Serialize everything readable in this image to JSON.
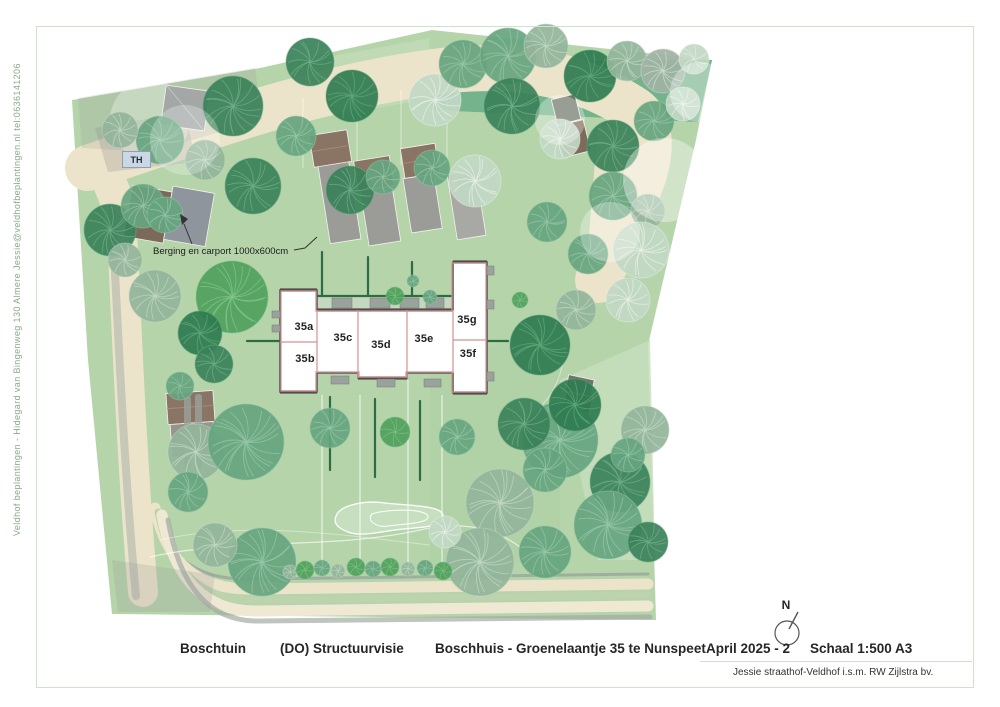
{
  "sidebar": {
    "text": "Veldhof beplantingen - Hidegard van Bingenweg 130 Almere   Jessie@veldhofbeplantingen.nl   tel:0636141206"
  },
  "plan": {
    "th_label": "TH",
    "annotation_carport": "Berging en carport 1000x600cm",
    "north_label": "N",
    "units": [
      {
        "label": "35a"
      },
      {
        "label": "35b"
      },
      {
        "label": "35c"
      },
      {
        "label": "35d"
      },
      {
        "label": "35e"
      },
      {
        "label": "35f"
      },
      {
        "label": "35g"
      }
    ],
    "colors": {
      "lawn": "#b5d4aa",
      "lawn_light": "#c7dfbe",
      "band_dark": "#74b38c",
      "path_cream": "#ece4ca",
      "path_cream2": "#efe8d2",
      "road_gray": "#a2aba3",
      "road_sage": "#bcd3ae",
      "roof_brown": "#8a7463",
      "building_gray": "#9b9b97",
      "building_gray_light": "#a8a8a4",
      "berging_brown": "#7b6a5a",
      "carport_gray": "#8e959c",
      "dark_roof": "#6e7568",
      "building_fill": "#ffffff",
      "wall_dark": "#4f4f4f",
      "partition_red": "#d49090",
      "hedge_green": "#2f6b45",
      "terrace": "#cdd8c8",
      "pond": "#c6e0bf",
      "frame": "#cfe0cb",
      "text_dark": "#262626",
      "side_text_green": "#85ab85",
      "th_bg": "#ccd7e6",
      "tree_palettes": {
        "d": [
          "#3a8159",
          "#70ae89"
        ],
        "m": [
          "#66a47f",
          "#98c7aa"
        ],
        "s": [
          "#93b49a",
          "#c3d8c6"
        ],
        "p": [
          "#c2d8c4",
          "#e8f1e8"
        ],
        "b": [
          "#4f9f5d",
          "#84c58e"
        ],
        "o": [
          "#2f7b50",
          "#5fa87c"
        ],
        "g": [
          "#9fb3a4",
          "#d0dcd0"
        ]
      }
    }
  },
  "title_block": {
    "garden_name": "Boschtuin",
    "phase": "(DO) Structuurvisie",
    "address": "Boschhuis - Groenelaantje 35 te Nunspeet",
    "date": "April 2025 - 2",
    "scale": "Schaal 1:500  A3",
    "credit": "Jessie straathof-Veldhof i.s.m. RW Zijlstra bv."
  }
}
